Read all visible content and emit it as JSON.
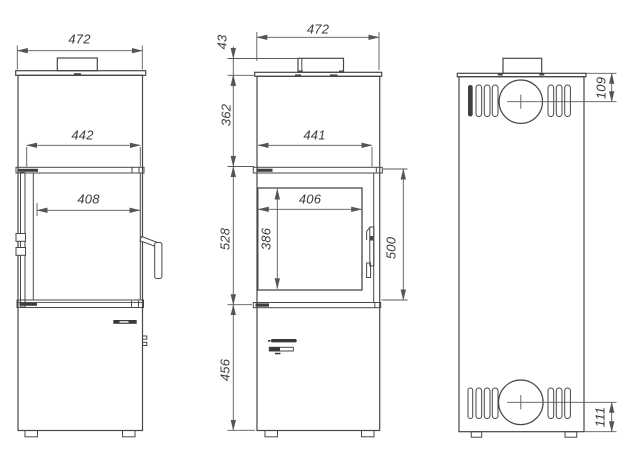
{
  "canvas": {
    "background": "#ffffff"
  },
  "colors": {
    "outline": "#474747",
    "dimension_line": "#5a5a5a",
    "label_text": "#3b3b3b"
  },
  "views": {
    "side": {
      "dims": {
        "overall_width": "472",
        "top_width": "442",
        "glass_depth": "408"
      }
    },
    "front": {
      "dims": {
        "overall_width": "472",
        "flue_collar_height": "43",
        "upper_section_height": "362",
        "inner_width": "441",
        "glass_width": "406",
        "glass_height": "386",
        "firebox_section_height": "528",
        "door_height": "500",
        "base_section_height": "456"
      }
    },
    "back": {
      "dims": {
        "flue_center_from_top": "109",
        "inlet_center_from_bottom": "111"
      }
    }
  }
}
